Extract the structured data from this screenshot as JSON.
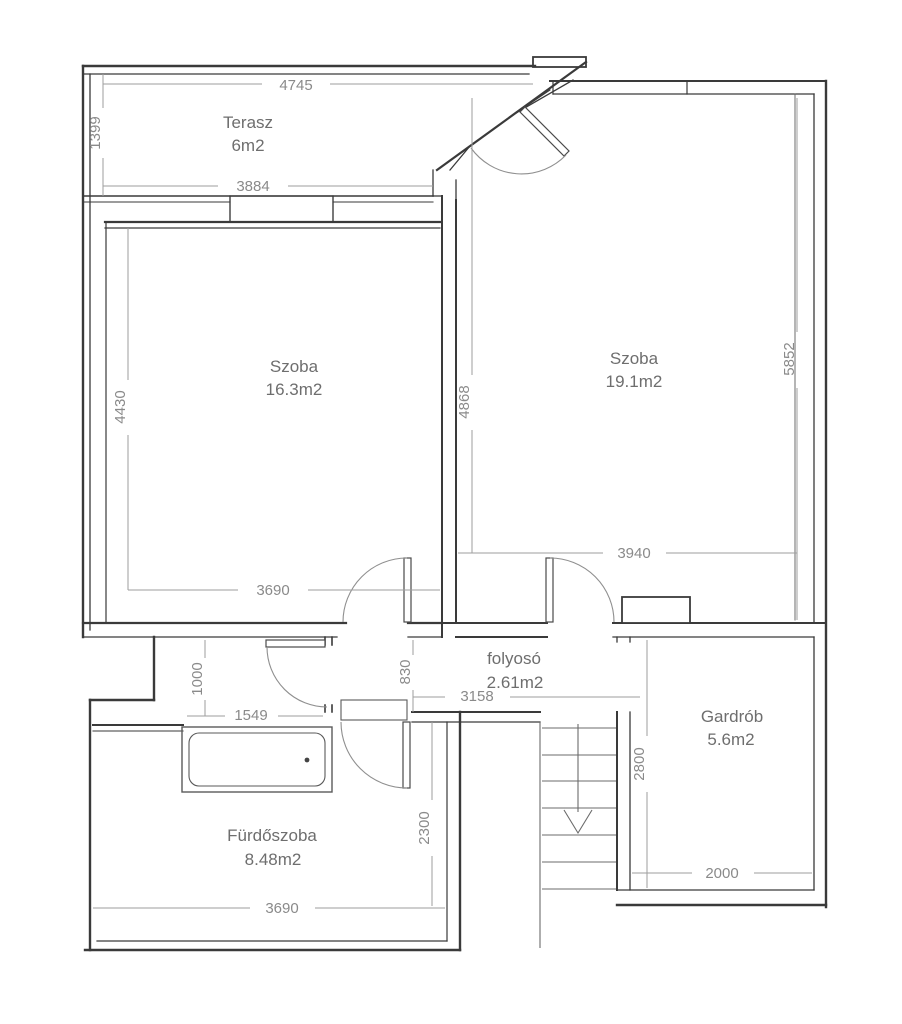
{
  "plan": {
    "drawing_type": "floor-plan",
    "rooms": [
      {
        "name": "Terasz",
        "area": "6m2"
      },
      {
        "name": "Szoba",
        "area": "16.3m2"
      },
      {
        "name": "Szoba",
        "area": "19.1m2"
      },
      {
        "name": "folyosó",
        "area": "2.61m2"
      },
      {
        "name": "Gardrób",
        "area": "5.6m2"
      },
      {
        "name": "Fürdőszoba",
        "area": "8.48m2"
      }
    ],
    "dimensions_mm": [
      {
        "label": "4745"
      },
      {
        "label": "1399"
      },
      {
        "label": "3884"
      },
      {
        "label": "4430"
      },
      {
        "label": "3690"
      },
      {
        "label": "4868"
      },
      {
        "label": "5852"
      },
      {
        "label": "3940"
      },
      {
        "label": "830"
      },
      {
        "label": "3158"
      },
      {
        "label": "1000"
      },
      {
        "label": "1549"
      },
      {
        "label": "2300"
      },
      {
        "label": "3690"
      },
      {
        "label": "2800"
      },
      {
        "label": "2000"
      }
    ],
    "colors": {
      "wall": "#3a3a3a",
      "thin_line": "#5a5a5a",
      "dim_line": "#9e9e9e",
      "dim_text": "#8a8a8a",
      "label_text": "#6e6e6e",
      "background": "#ffffff"
    }
  }
}
